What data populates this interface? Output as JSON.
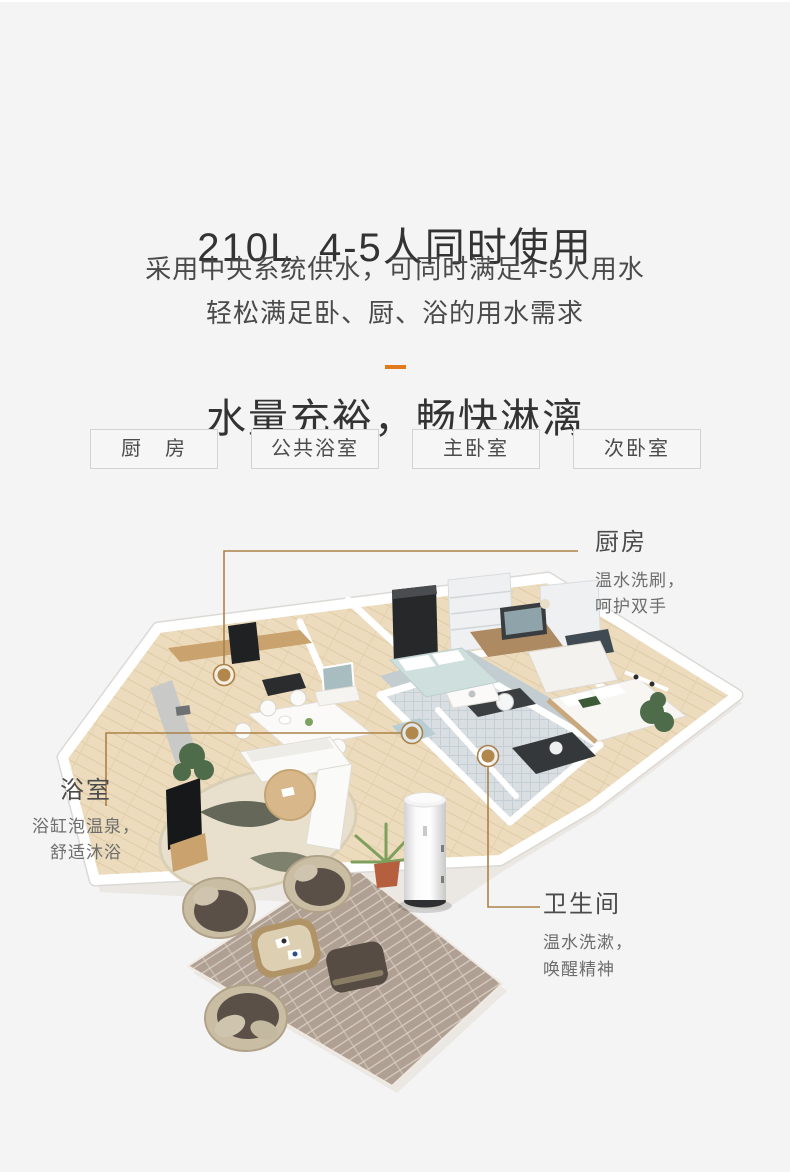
{
  "page": {
    "background": "#f4f4f5",
    "accent": "#e2791d",
    "callout_line_color": "#ab8148",
    "callout_dot_color": "#b2874b"
  },
  "header": {
    "title_line1": "210L  4-5人同时使用",
    "title_line2": "水量充裕，畅快淋漓",
    "subtitle_line1": "采用中央系统供水，可同时满足4-5人用水",
    "subtitle_line2": "轻松满足卧、厨、浴的用水需求"
  },
  "room_tabs": [
    {
      "label": "厨　房"
    },
    {
      "label": "公共浴室"
    },
    {
      "label": "主卧室"
    },
    {
      "label": "次卧室"
    }
  ],
  "callouts": {
    "kitchen": {
      "title": "厨房",
      "line1": "温水洗刷，",
      "line2": "呵护双手"
    },
    "bathroom": {
      "title": "浴室",
      "line1": "浴缸泡温泉，",
      "line2": "舒适沐浴"
    },
    "toilet": {
      "title": "卫生间",
      "line1": "温水洗漱，",
      "line2": "唤醒精神"
    }
  }
}
